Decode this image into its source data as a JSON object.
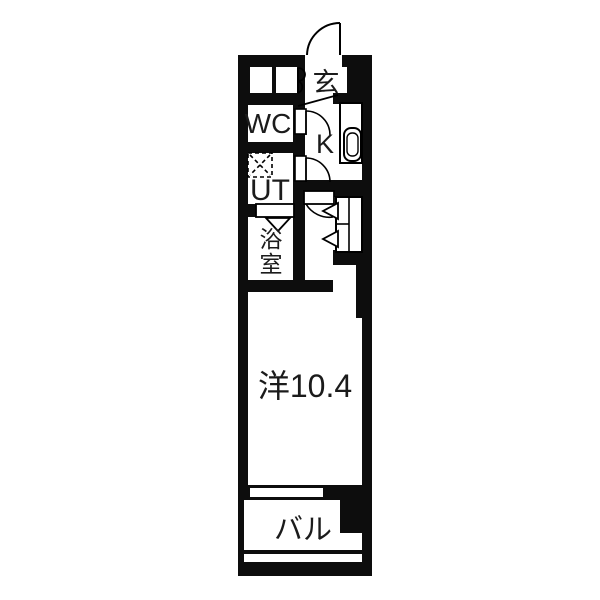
{
  "floorplan": {
    "type": "apartment-floor-plan",
    "rooms": {
      "entrance": {
        "label": "玄"
      },
      "toilet": {
        "label": "WC"
      },
      "kitchen": {
        "label": "K"
      },
      "utility": {
        "label": "UT"
      },
      "bathroom": {
        "label": "浴室"
      },
      "main_room": {
        "label": "洋10.4",
        "size_tatami": "10.4"
      },
      "balcony": {
        "label": "バル"
      }
    },
    "colors": {
      "wall": "#0d0d0d",
      "background": "#ffffff",
      "line": "#000000",
      "text": "#1b1b1b"
    }
  }
}
